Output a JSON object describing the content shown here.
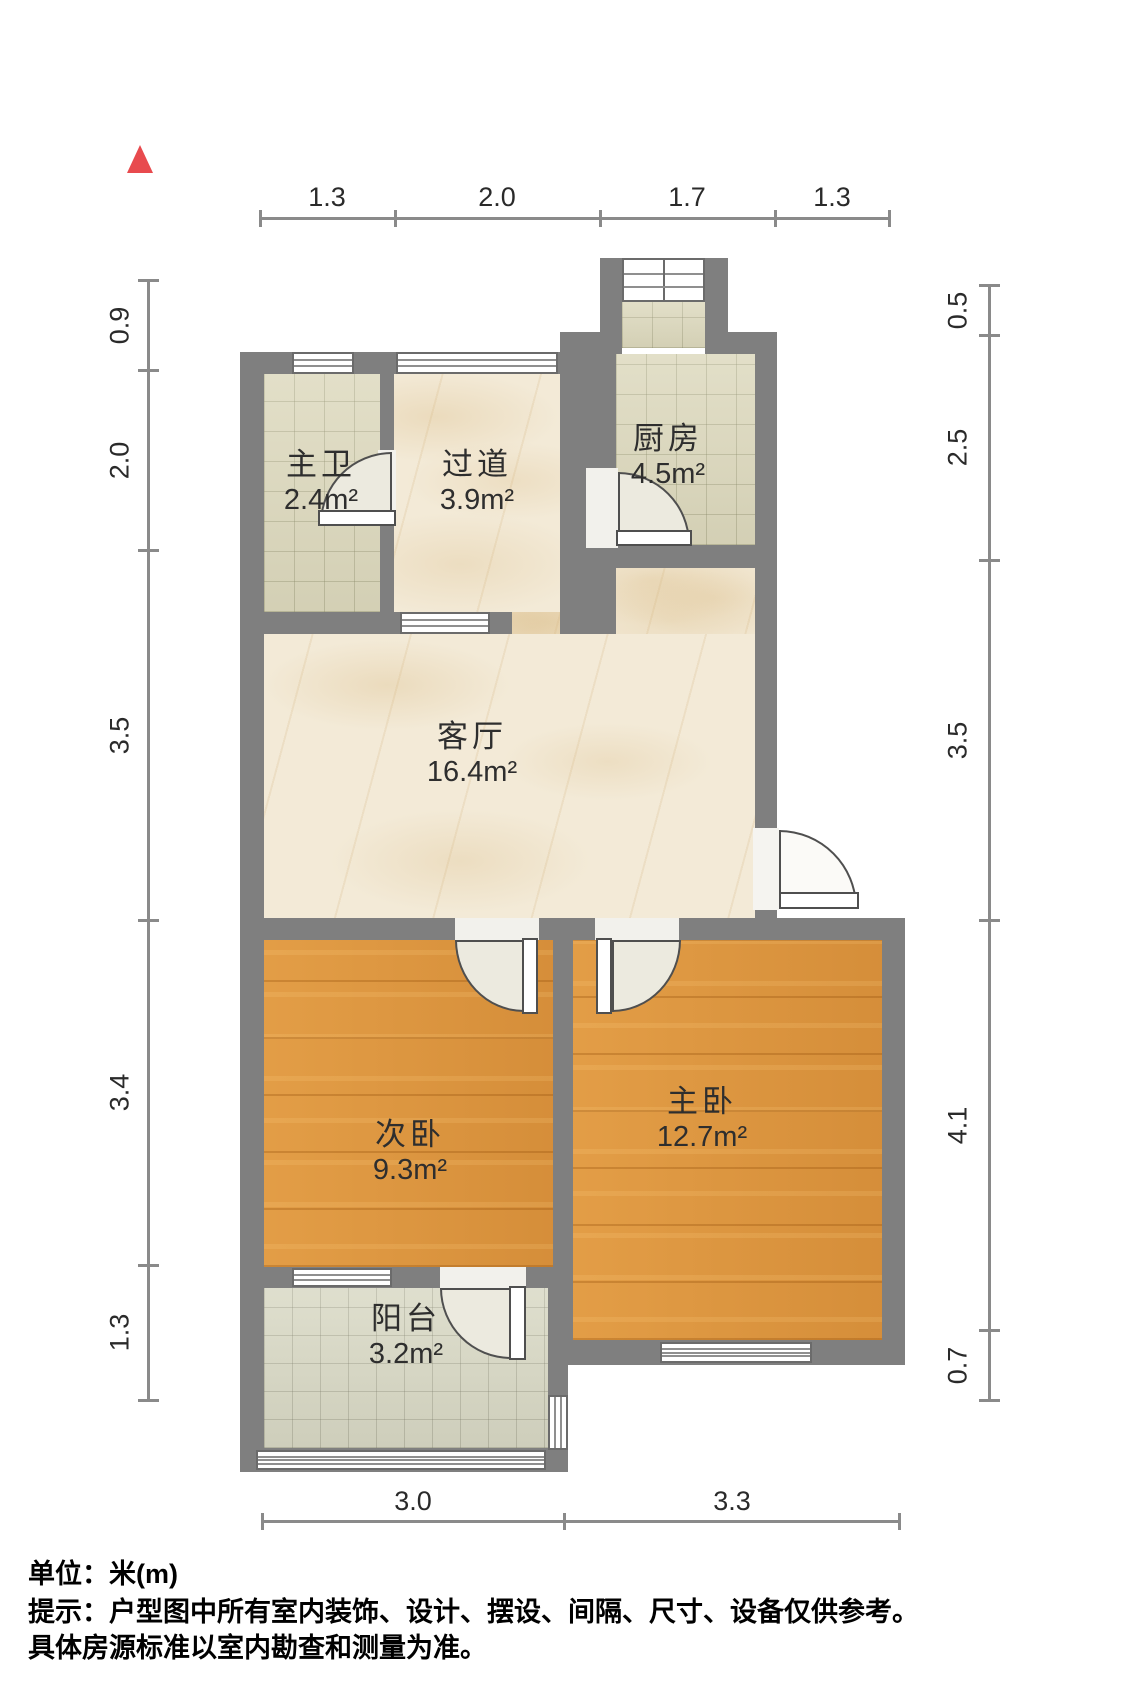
{
  "plan_type": "apartment-floor-plan",
  "icons": {
    "north_indicator": "north-arrow-triangle"
  },
  "rooms": {
    "bathroom": {
      "name": "主卫",
      "area": "2.4m²"
    },
    "hallway": {
      "name": "过道",
      "area": "3.9m²"
    },
    "kitchen": {
      "name": "厨房",
      "area": "4.5m²"
    },
    "living_room": {
      "name": "客厅",
      "area": "16.4m²"
    },
    "second_bedroom": {
      "name": "次卧",
      "area": "9.3m²"
    },
    "master_bedroom": {
      "name": "主卧",
      "area": "12.7m²"
    },
    "balcony": {
      "name": "阳台",
      "area": "3.2m²"
    }
  },
  "dimensions_m": {
    "top": [
      "1.3",
      "2.0",
      "1.7",
      "1.3"
    ],
    "left": [
      "0.9",
      "2.0",
      "3.5",
      "3.4",
      "1.3"
    ],
    "right": [
      "0.5",
      "2.5",
      "3.5",
      "4.1",
      "0.7"
    ],
    "bottom": [
      "3.0",
      "3.3"
    ]
  },
  "footer": {
    "unit_label": "单位：米(m)",
    "note_line1": "提示：户型图中所有室内装饰、设计、摆设、间隔、尺寸、设备仅供参考。",
    "note_line2": "具体房源标准以室内勘查和测量为准。"
  },
  "colors": {
    "wall": "#7f7f7f",
    "wood_floor": "#de9740",
    "marble_floor": "#f3ead7",
    "tile_floor": "#dcd8bc",
    "balcony_floor": "#d9d9c5",
    "north_arrow": "#e84a4e",
    "dimension_line": "#8a8a8a"
  }
}
